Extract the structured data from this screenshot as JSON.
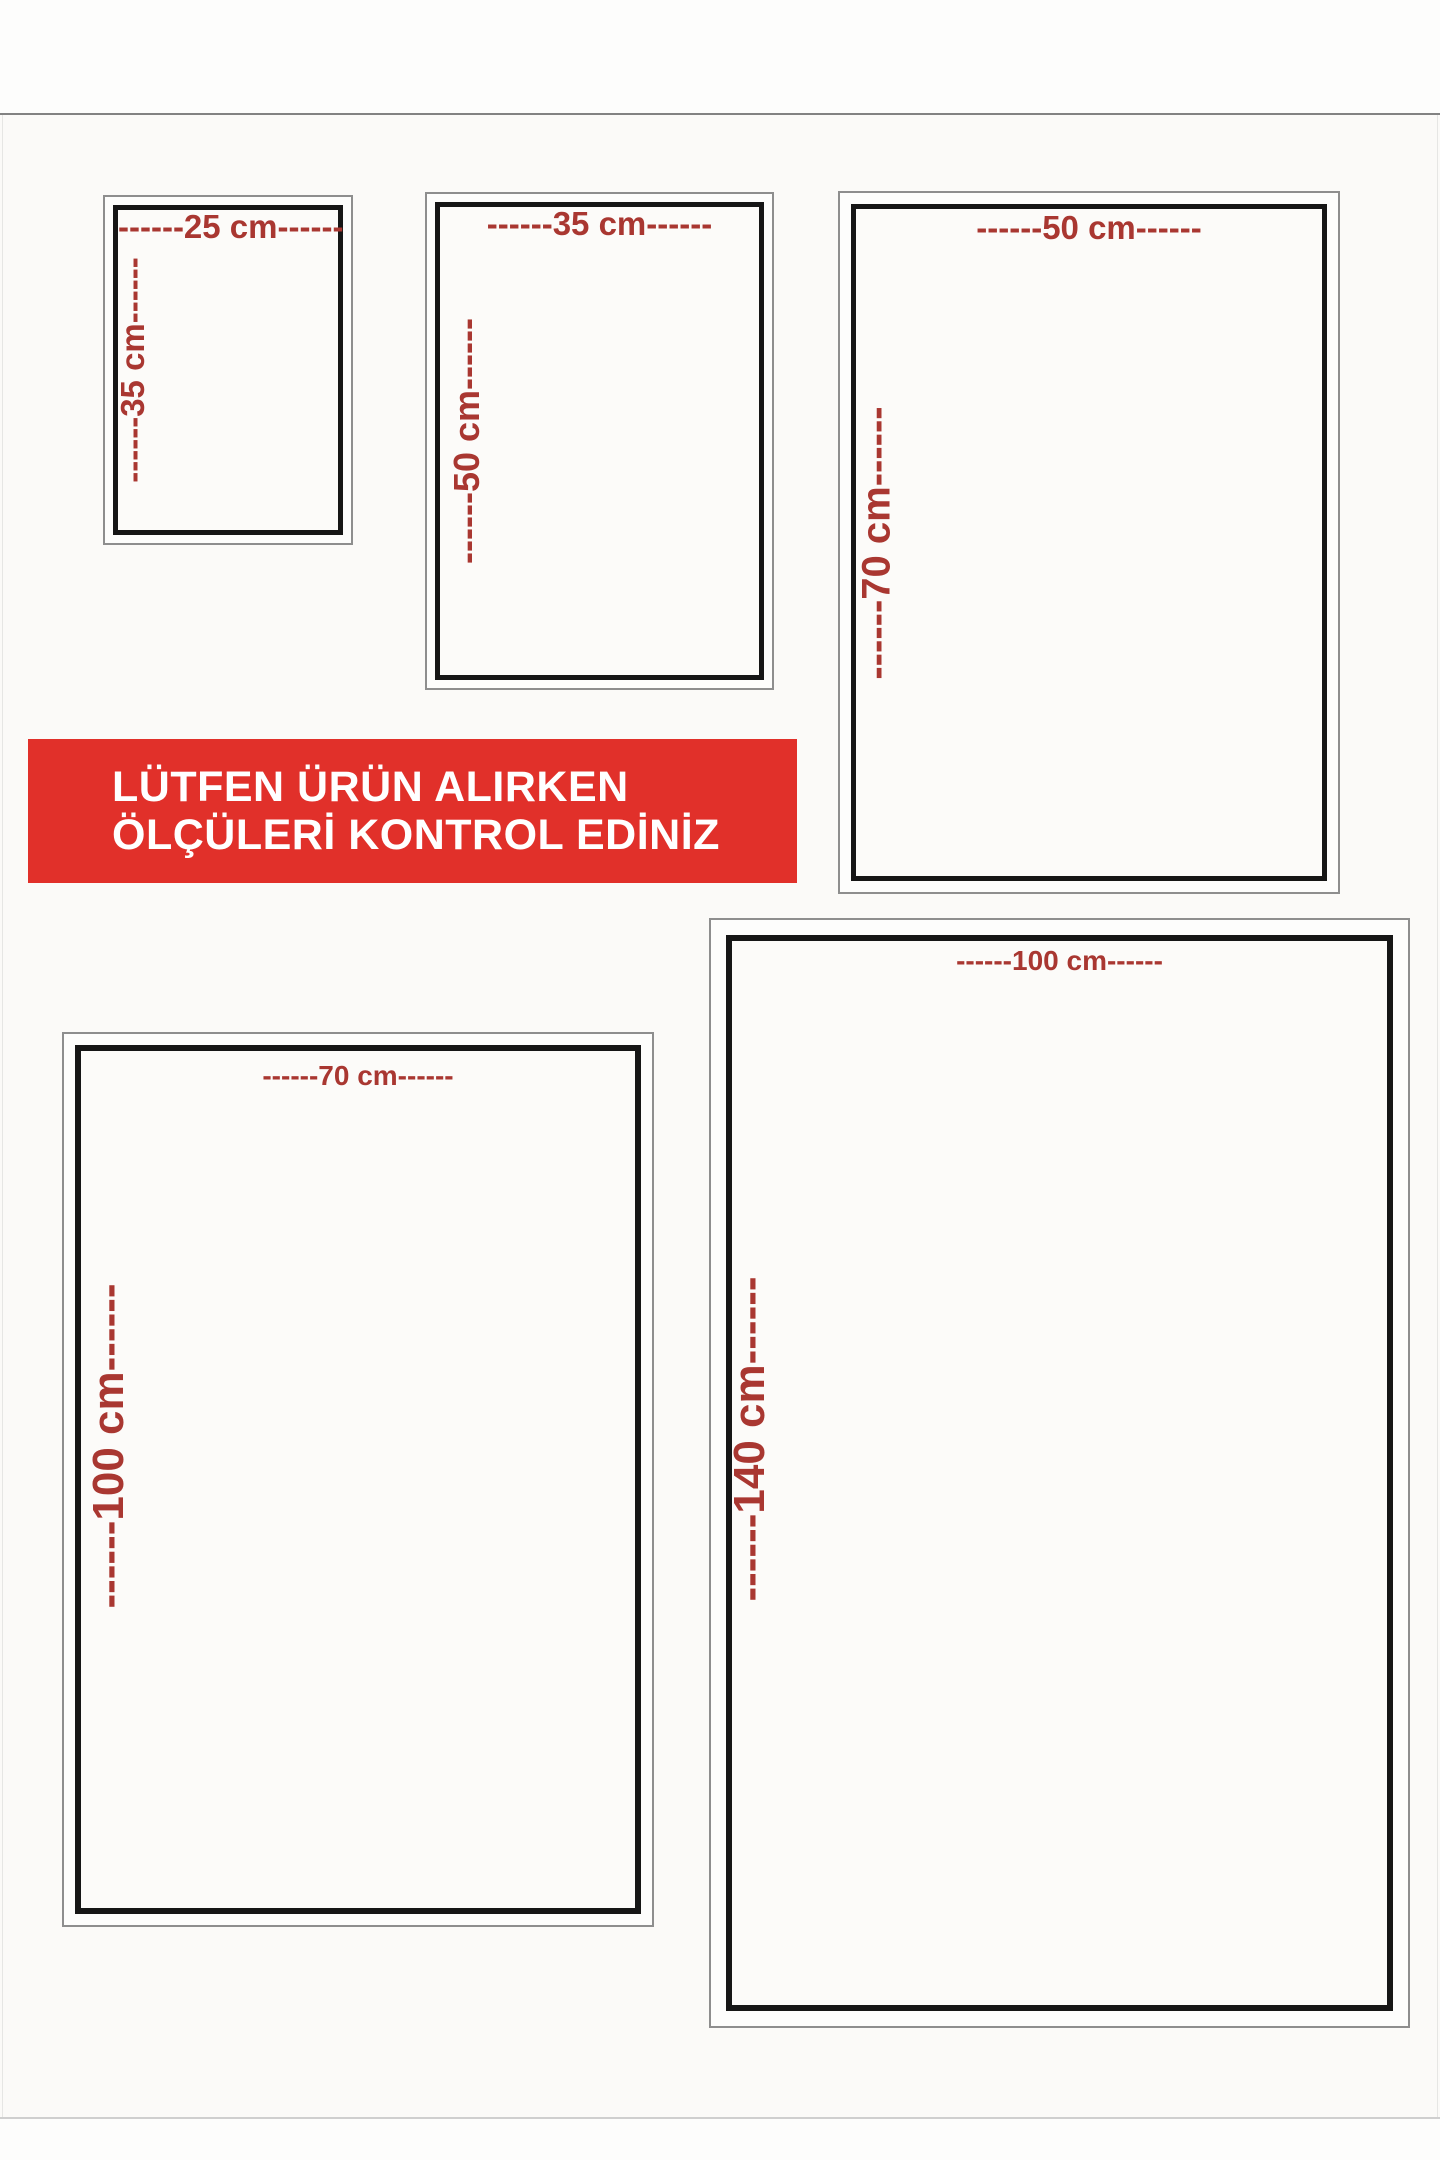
{
  "banner": {
    "line1": "LÜTFEN ÜRÜN ALIRKEN",
    "line2": "ÖLÇÜLERİ KONTROL EDİNİZ",
    "background_color": "#e1302a",
    "text_color": "#ffffff"
  },
  "colors": {
    "dimension_text": "#a93731",
    "box_border": "#161616",
    "outer_frame": "#8e8e8e",
    "page_background": "#fdfdfc"
  },
  "sizes": [
    {
      "name": "25 cm x 35 cm",
      "width_value": "25 cm",
      "height_value": "35 cm",
      "width_label": "------25 cm------",
      "height_label": "------35 cm------"
    },
    {
      "name": "35 cm x 50 cm",
      "width_value": "35 cm",
      "height_value": "50 cm",
      "width_label": "------35 cm------",
      "height_label": "------50 cm------"
    },
    {
      "name": "50 cm x 70 cm",
      "width_value": "50 cm",
      "height_value": "70 cm",
      "width_label": "------50 cm------",
      "height_label": "------70 cm------"
    },
    {
      "name": "70 cm x 100 cm",
      "width_value": "70 cm",
      "height_value": "100 cm",
      "width_label": "------70 cm------",
      "height_label": "------100 cm------"
    },
    {
      "name": "100 cm x 140 cm",
      "width_value": "100 cm",
      "height_value": "140 cm",
      "width_label": "------100 cm------",
      "height_label": "------140 cm------"
    }
  ]
}
